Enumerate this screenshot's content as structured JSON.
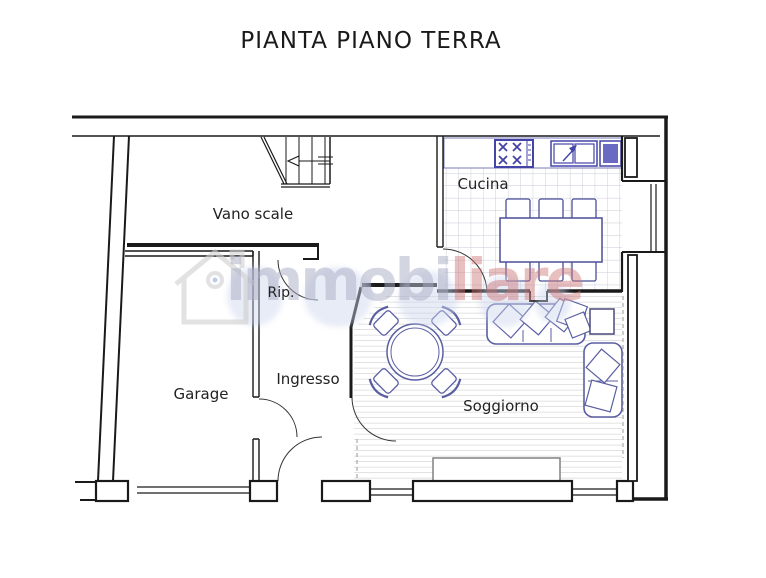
{
  "title": "PIANTA PIANO TERRA",
  "rooms": {
    "vano_scale": "Vano scale",
    "cucina": "Cucina",
    "rip": "Rip.",
    "garage": "Garage",
    "ingresso": "Ingresso",
    "soggiorno": "Soggiorno"
  },
  "watermark": {
    "text_left": "immobi",
    "text_right": "liare"
  },
  "colors": {
    "wall": "#1a1a1a",
    "furniture_outline": "#5a5fa2",
    "appliance_blue": "#4343a8",
    "appliance_fill": "#6a6ac2",
    "tile_line": "#c9cbd8",
    "plank_line": "#d8d8d8",
    "watermark_gray": "#a8acc4",
    "watermark_red": "#ce7474"
  }
}
